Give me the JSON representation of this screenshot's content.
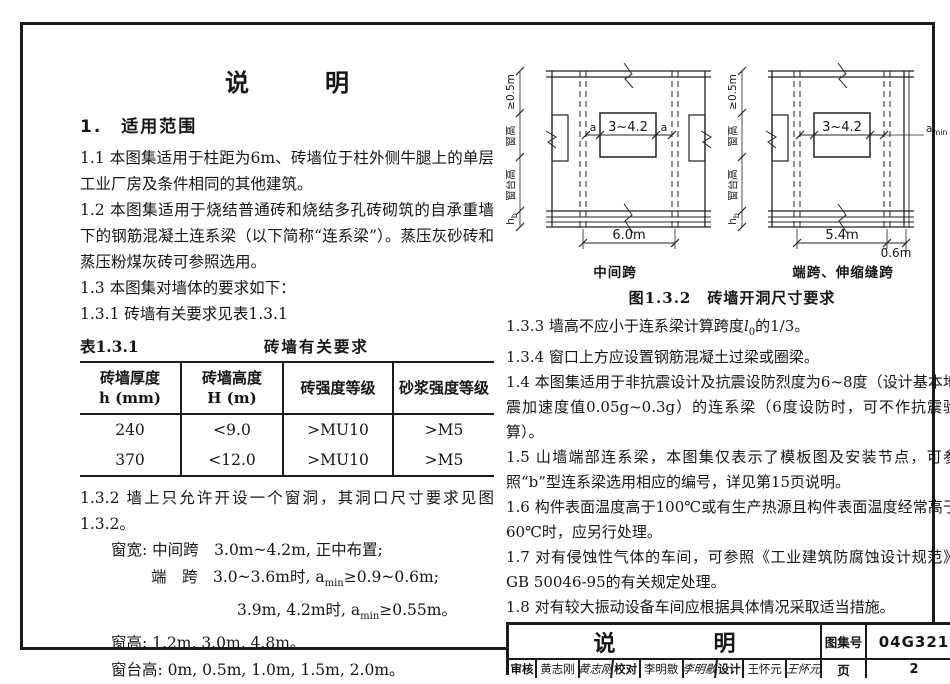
{
  "colors": {
    "ink": "#1b1b1b",
    "paper": "#ffffff"
  },
  "title": "说　明",
  "left": {
    "s1": "1.　适用范围",
    "p11": "1.1 本图集适用于柱距为6m、砖墙位于柱外侧牛腿上的单层工业厂房及条件相同的其他建筑。",
    "p12": "1.2  本图集适用于烧结普通砖和烧结多孔砖砌筑的自承重墙下的钢筋混凝土连系梁（以下简称“连系梁”）。蒸压灰砂砖和蒸压粉煤灰砖可参照选用。",
    "p13": "1.3 本图集对墙体的要求如下：",
    "p131": "1.3.1 砖墙有关要求见表1.3.1",
    "table": {
      "label": "表1.3.1",
      "title": "砖墙有关要求",
      "headers": [
        {
          "l1": "砖墙厚度",
          "l2": "h (mm)"
        },
        {
          "l1": "砖墙高度",
          "l2": "H (m)"
        },
        {
          "l1": "砖强度等级",
          "l2": ""
        },
        {
          "l1": "砂浆强度等级",
          "l2": ""
        }
      ],
      "rows": [
        [
          "240",
          "<9.0",
          ">MU10",
          ">M5"
        ],
        [
          "370",
          "<12.0",
          ">MU10",
          ">M5"
        ]
      ]
    },
    "p132": "1.3.2 墙上只允许开设一个窗洞，其洞口尺寸要求见图1.3.2。",
    "spec_kuan": "窗宽: 中间跨　3.0m~4.2m, 正中布置;",
    "spec_duan": {
      "pre": "端　跨　3.0~3.6m时, a",
      "sub": "min",
      "post": "≥0.9~0.6m;"
    },
    "spec_39": {
      "pre": "3.9m, 4.2m时, a",
      "sub": "min",
      "post": "≥0.55m。"
    },
    "spec_gao": "窗高: 1.2m, 3.0m, 4.8m。",
    "spec_tai": "窗台高: 0m, 0.5m, 1.0m, 1.5m, 2.0m。"
  },
  "right": {
    "fig_caption": "图1.3.2　砖墙开洞尺寸要求",
    "p133": {
      "pre": "1.3.3 墙高不应小于连系梁计算跨度",
      "var": "l",
      "sub": "0",
      "post": "的1/3。"
    },
    "p134": "1.3.4 窗口上方应设置钢筋混凝土过梁或圈梁。",
    "p14": "1.4 本图集适用于非抗震设计及抗震设防烈度为6~8度（设计基本地震加速度值0.05g~0.3g）的连系梁（6度设防时，可不作抗震验算）。",
    "p15": "1.5 山墙端部连系梁，本图集仅表示了模板图及安装节点，可参照“b”型连系梁选用相应的编号，详见第15页说明。",
    "p16": "1.6 构件表面温度高于100℃或有生产热源且构件表面温度经常高于60℃时，应另行处理。",
    "p17": "1.7 对有侵蚀性气体的车间，可参照《工业建筑防腐蚀设计规范》GB 50046-95的有关规定处理。",
    "p18": "1.8 对有较大振动设备车间应根据具体情况采取适当措施。"
  },
  "diagrams": {
    "mid": {
      "caption": "中间跨",
      "dim_top": "≥0.5m",
      "dim_win": "窗高",
      "dim_sill": "窗台高",
      "hb_main": "h",
      "hb_sub": "b",
      "a_left": "a",
      "a_right": "a",
      "opening": "3~4.2",
      "span": "6.0m"
    },
    "end": {
      "caption": "端跨、伸缩缝跨",
      "dim_top": "≥0.5m",
      "dim_win": "窗高",
      "dim_sill": "窗台高",
      "hb_main": "h",
      "hb_sub": "b",
      "a_left": "a",
      "amin_main": "a",
      "amin_sub": "min",
      "opening": "3~4.2",
      "span": "5.4m",
      "offset": "0.6m"
    }
  },
  "titleblock": {
    "title": "说　明",
    "atlas_label": "图集号",
    "atlas_no": "04G321",
    "page_label": "页",
    "page_no": "2",
    "roles": [
      {
        "label": "审核",
        "name": "黄志刚",
        "sig": "黄志刚"
      },
      {
        "label": "校对",
        "name": "李明敭",
        "sig": "李明敭"
      },
      {
        "label": "设计",
        "name": "王怀元",
        "sig": "王怀元"
      }
    ]
  }
}
